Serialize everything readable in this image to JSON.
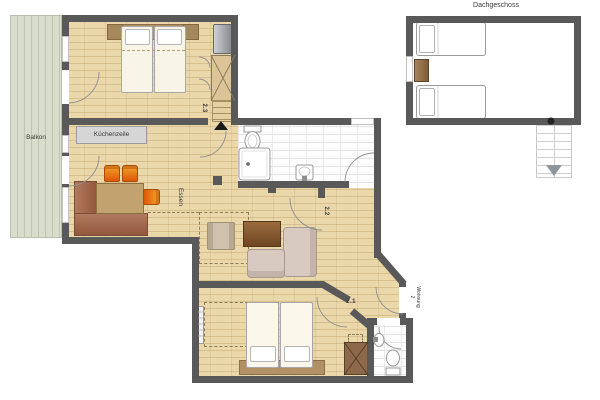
{
  "plan_title": "apartment floor plan Wohnung 2 with Dachgeschoss",
  "labels": {
    "attic": "Dachgeschoss",
    "balcony": "Balkon",
    "kitchenette": "Küchenzeile",
    "dining": "Essen",
    "room23": "2.3",
    "room22": "2.2",
    "room21": "2.1",
    "apartment_line1": "Wohnung",
    "apartment_line2": "2"
  },
  "colors": {
    "wall": "#595959",
    "floor": "#ead7aa",
    "balcony_floor": "#d9ddcb",
    "tile_floor": "#fdfdfd",
    "chair_orange": "#e8720e",
    "bench_brown": "#a56b50",
    "table_wood": "#c2a36f",
    "coffee_table": "#8a5f33",
    "sofa": "#d8c9c1",
    "bed_linen": "#f8f4e6",
    "headboard": "#b29066",
    "wardrobe_light": "#dcc398",
    "wardrobe_dark": "#8d684b",
    "outline_gray": "#8f8f8f"
  }
}
